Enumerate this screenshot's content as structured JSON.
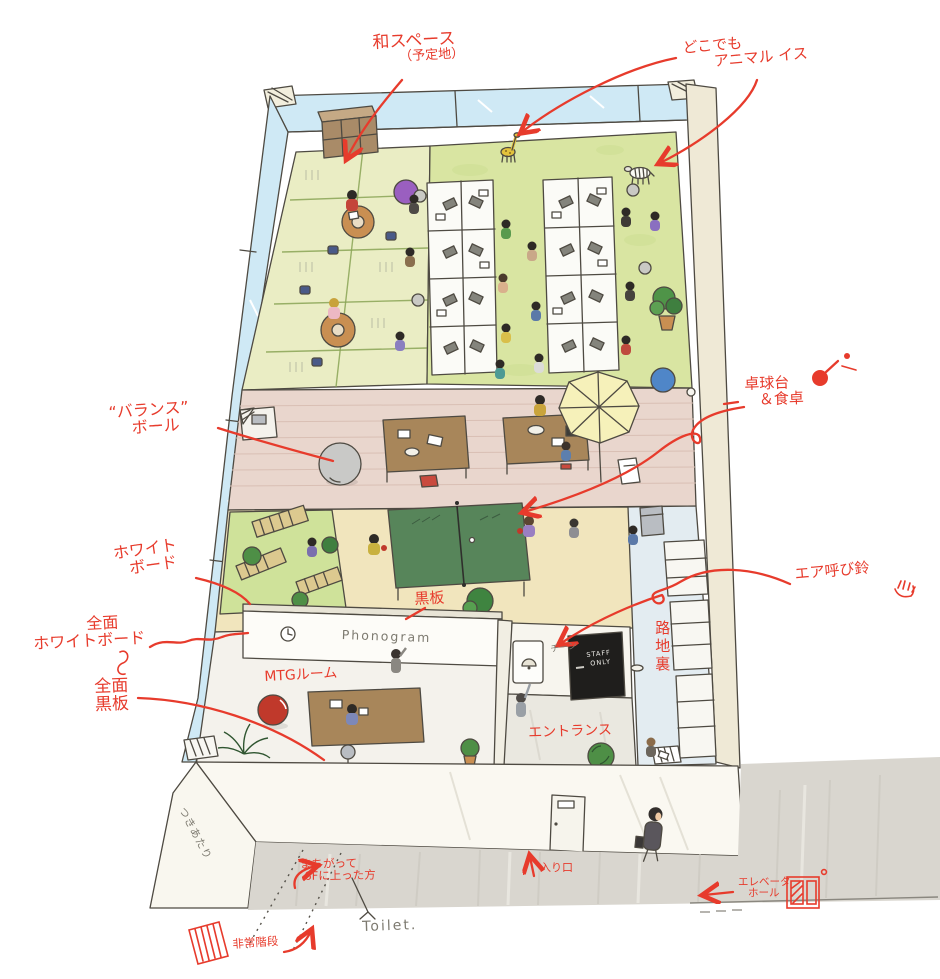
{
  "scene": {
    "description": "Hand-drawn isometric illustration of the Phonogram office 6F floor plan with red handwritten annotations",
    "colors": {
      "annotation_red": "#e73b2c",
      "pencil_gray": "#7d7a70",
      "window_blue": "#cfe9f5",
      "carpet_green": "#d9e5a2",
      "tatami_green": "#eaedc4",
      "floor_pink": "#e9d6cd",
      "floor_beige": "#f1e5bd",
      "alley_blue": "#e3ecf1",
      "pingpong_green": "#57855a",
      "concrete_gray": "#d9d6cf"
    },
    "icons": {
      "up_arrow": "↑",
      "left_arrow": "←",
      "stairs": "stairs-doodle",
      "elevator": "elevator-doodle",
      "paddle": "ping-pong-paddle-doodle",
      "hand": "pressing-hand-doodle",
      "bell": "doorbell-doodle",
      "clock": "wall-clock-doodle"
    }
  },
  "labels": {
    "wa_space": {
      "line1": "和スペース",
      "line2": "（予定地）"
    },
    "anywhere_animal_chair": {
      "line1": "どこでも",
      "line2": "アニマル イス"
    },
    "balance_ball": {
      "line1": "“バランス”",
      "line2": "ボール"
    },
    "pingpong_dining": {
      "line1": "卓球台",
      "line2": "＆食卓"
    },
    "whiteboard": {
      "line1": "ホワイト",
      "line2": "ボード"
    },
    "full_whiteboard": {
      "line1": "全面",
      "line2": "ホワイトボード"
    },
    "full_blackboard": {
      "line1": "全面",
      "line2": "黒板"
    },
    "blackboard": "黒板",
    "mtg_room": "MTGルーム",
    "entrance_room": "エントランス",
    "air_doorbell": "エア呼び鈴",
    "back_alley": "路地裏",
    "entry": "入り口",
    "elevator_hall": {
      "line1": "エレベータ",
      "line2": "ホール"
    },
    "wrong_floor": {
      "line1": "まちがって",
      "line2": "6Fに上った方"
    },
    "emergency_stairs": "非常階段",
    "toilet": "Toilet.",
    "dead_end": "つきあたり",
    "phonogram": "Phonogram",
    "staff_only": {
      "line1": "STAFF",
      "line2": "ONLY"
    },
    "ding": "チーン"
  }
}
